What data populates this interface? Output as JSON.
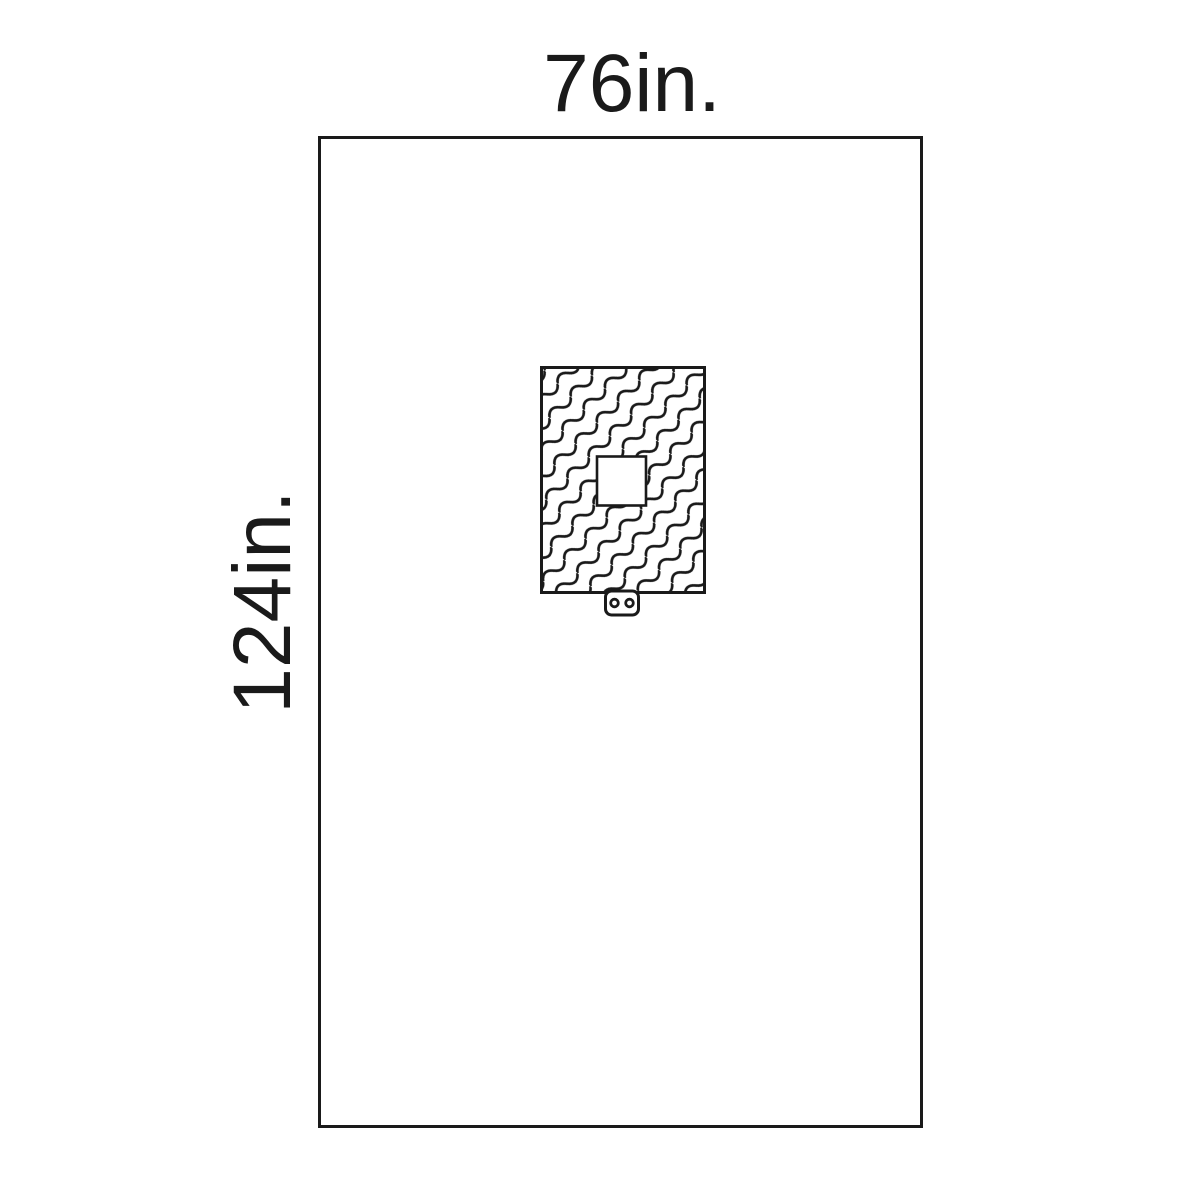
{
  "labels": {
    "width": "76in.",
    "height": "124in."
  },
  "colors": {
    "ink": "#1a1a1a",
    "background": "#ffffff"
  },
  "diagram": {
    "type": "product-line-drawing",
    "parts": [
      "drape-outline",
      "reinforcement-patch-wave-pattern",
      "fenestration-square",
      "tube-holder-tab"
    ]
  }
}
